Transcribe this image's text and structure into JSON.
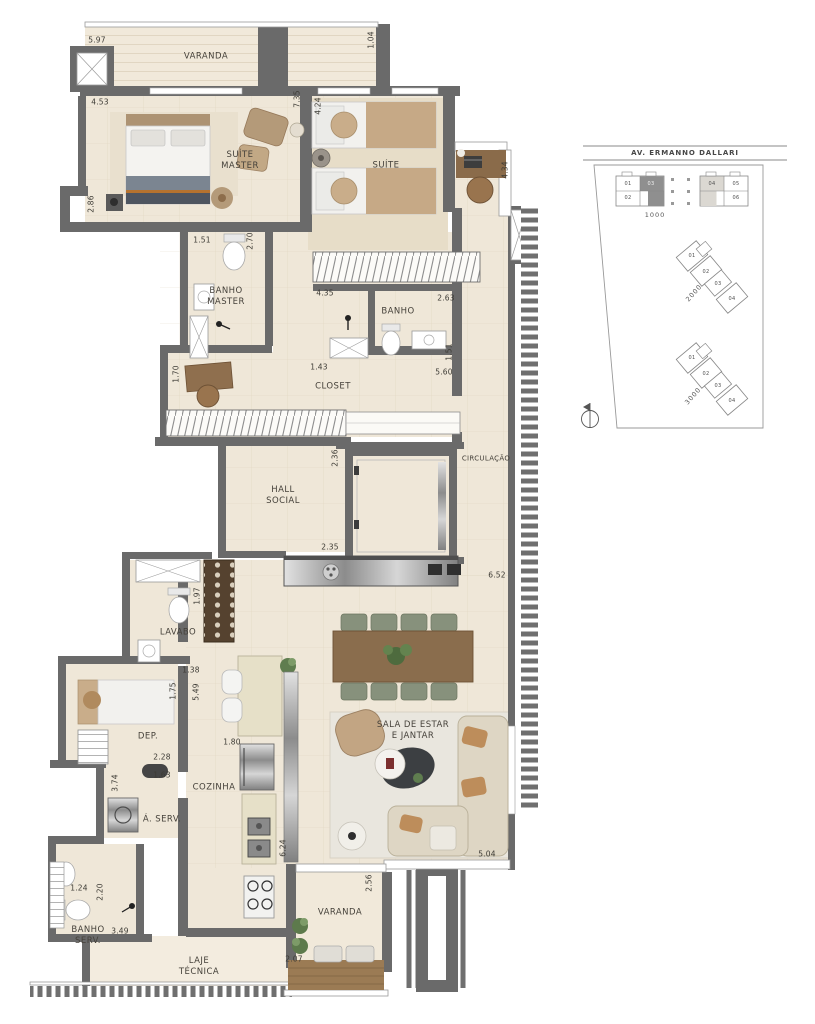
{
  "plan": {
    "rooms": {
      "varanda_top": "VARANDA",
      "suite_master": "SUÍTE\nMASTER",
      "suite": "SUÍTE",
      "banho_master": "BANHO\nMASTER",
      "banho": "BANHO",
      "closet": "CLOSET",
      "hall_social": "HALL\nSOCIAL",
      "circulacao": "CIRCULAÇÃO",
      "lavabo": "LAVABO",
      "dep": "DEP.",
      "cozinha": "COZINHA",
      "area_servico": "Á. SERV.",
      "sala": "SALA DE ESTAR\nE JANTAR",
      "banho_serv": "BANHO\nSERV.",
      "laje_tecnica": "LAJE\nTÉCNICA",
      "varanda_bottom": "VARANDA"
    },
    "dims": [
      "5.97",
      "1.04",
      "4.53",
      "7.35",
      "4.24",
      "4.34",
      "2.86",
      "1.51",
      "2.70",
      "4.35",
      "2.63",
      "1.43",
      "1.51",
      "5.60",
      "1.70",
      "2.36",
      "2.35",
      "6.52",
      "1.97",
      "1.38",
      "1.75",
      "5.49",
      "2.28",
      "1.63",
      "3.74",
      "1.80",
      "5.04",
      "1.24",
      "2.20",
      "3.49",
      "6.24",
      "2.07",
      "2.56"
    ]
  },
  "siteplan": {
    "street": "AV. ERMANNO DALLARI",
    "buildings": [
      {
        "name": "1000",
        "units": [
          "01",
          "02",
          "03",
          "04",
          "05",
          "06"
        ]
      },
      {
        "name": "2000",
        "units": [
          "01",
          "02",
          "03",
          "04"
        ]
      },
      {
        "name": "3000",
        "units": [
          "01",
          "02",
          "03",
          "04"
        ]
      }
    ],
    "highlight_dark_unit": "03",
    "highlight_light_unit": "04"
  },
  "colors": {
    "wall": "#6a6a6a",
    "floor": "#efe7d8",
    "floor_light": "#f3ecdf",
    "wood": "#9b7b54",
    "table_wood": "#8a6d4d",
    "chair_green": "#87917c",
    "sofa": "#ded6c4",
    "tan": "#b49a79",
    "dark_rug": "#3c3f42",
    "metal": "#9a9a9a",
    "site_line": "#888888"
  }
}
